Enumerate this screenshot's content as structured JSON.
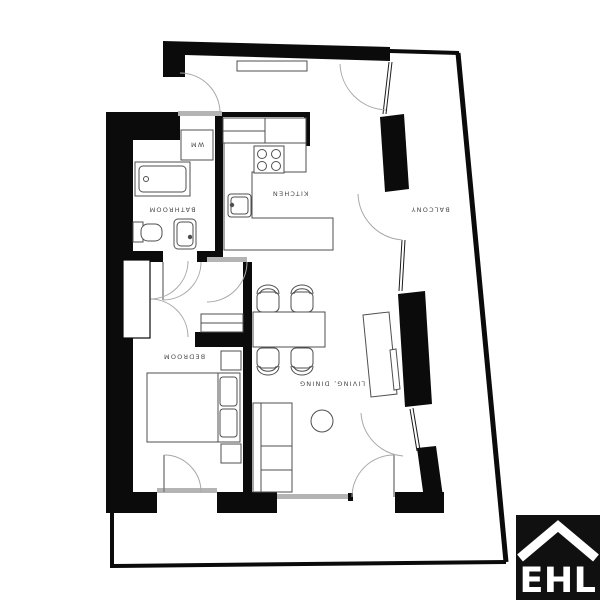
{
  "page": {
    "background": "#ffffff",
    "type": "floor-plan"
  },
  "plan": {
    "rooms": [
      {
        "id": "bathroom",
        "label": "BATHROOM"
      },
      {
        "id": "wm-niche",
        "label": "WM"
      },
      {
        "id": "kitchen",
        "label": "KITCHEN"
      },
      {
        "id": "bedroom",
        "label": "BEDROOM"
      },
      {
        "id": "living-dining",
        "label": "LIVING, DINING"
      },
      {
        "id": "balcony",
        "label": "BALCONY"
      }
    ],
    "label_orientation": "rotated-180",
    "fixtures": [
      "bathtub",
      "toilet",
      "washbasin",
      "washing-machine",
      "upper-cabinets",
      "kitchen-counter",
      "hob",
      "kitchen-sink",
      "entry-sideboard",
      "wardrobe",
      "bench",
      "dining-table",
      "dining-chairs",
      "sofa",
      "coffee-table",
      "tv-sideboard",
      "double-bed",
      "pillows",
      "nightstands"
    ],
    "colors": {
      "wall": "#0b0b0b",
      "furniture_outline": "#4f4f4f",
      "door_arc": "#a8a8a8",
      "threshold": "#b4b4b4",
      "label": "#4a4a4a",
      "background": "#ffffff"
    }
  },
  "logo": {
    "text": "EHL",
    "background": "#101010",
    "color": "#ffffff",
    "icon": "house-roof-icon"
  }
}
